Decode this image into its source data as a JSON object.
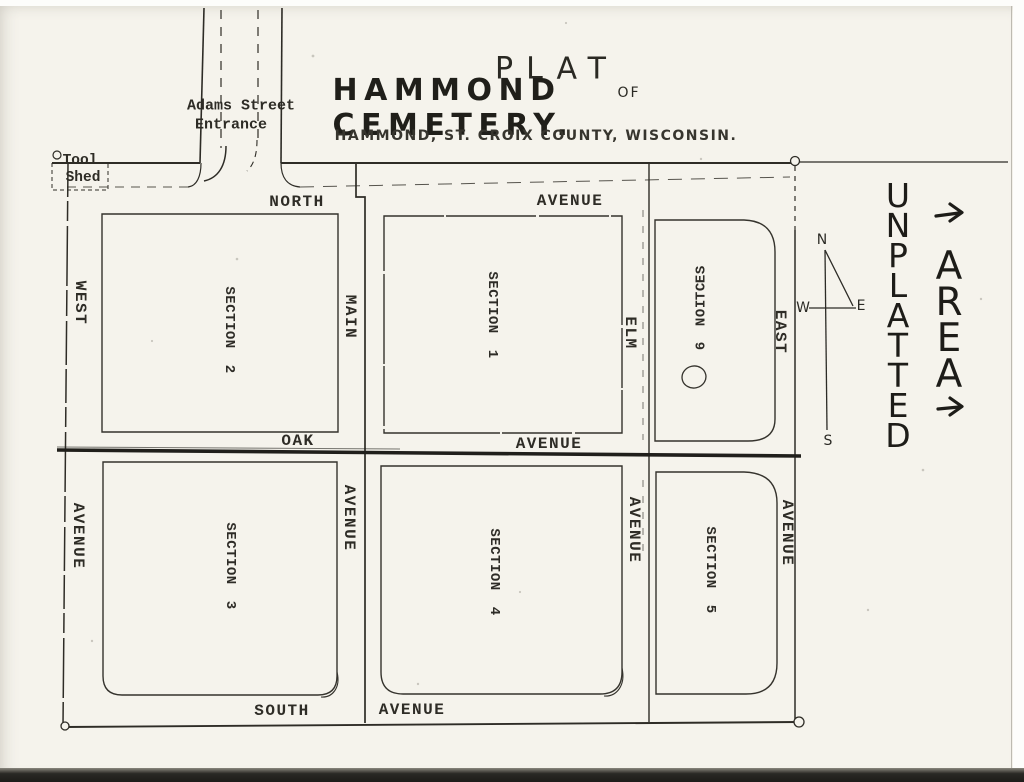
{
  "title": {
    "plat": "PLAT",
    "of": "OF",
    "name": "HAMMOND CEMETERY.",
    "subtitle": "HAMMOND, ST. CROIX COUNTY, WISCONSIN."
  },
  "entrance_label": {
    "line1": "Adams Street",
    "line2": "Entrance"
  },
  "tool_shed": {
    "line1": "Tool",
    "line2": "Shed"
  },
  "streets": {
    "north": {
      "word": "NORTH",
      "avenue": "AVENUE"
    },
    "oak": {
      "word": "OAK",
      "avenue": "AVENUE"
    },
    "south": {
      "word": "SOUTH",
      "avenue": "AVENUE"
    },
    "west": {
      "word": "WEST",
      "avenue": "AVENUE"
    },
    "main": {
      "word": "MAIN",
      "avenue": "AVENUE"
    },
    "elm": {
      "word": "ELM",
      "avenue": "AVENUE"
    },
    "east": {
      "word": "EAST",
      "avenue": "AVENUE"
    }
  },
  "sections": {
    "s1": {
      "word": "SECTION",
      "num": "1"
    },
    "s2": {
      "word": "SECTION",
      "num": "2"
    },
    "s3": {
      "word": "SECTION",
      "num": "3"
    },
    "s4": {
      "word": "SECTION",
      "num": "4"
    },
    "s5": {
      "word": "SECTION",
      "num": "5"
    },
    "s6": {
      "word": "SECTION",
      "num": "6"
    }
  },
  "compass": {
    "n": "N",
    "w": "W",
    "e": "E",
    "s": "S"
  },
  "unplatted": {
    "line1": "UNPLATTED",
    "line2": "AREA"
  },
  "colors": {
    "ink": "#2e2c26",
    "road": "#201f1b",
    "paper": "#f5f3ec"
  }
}
